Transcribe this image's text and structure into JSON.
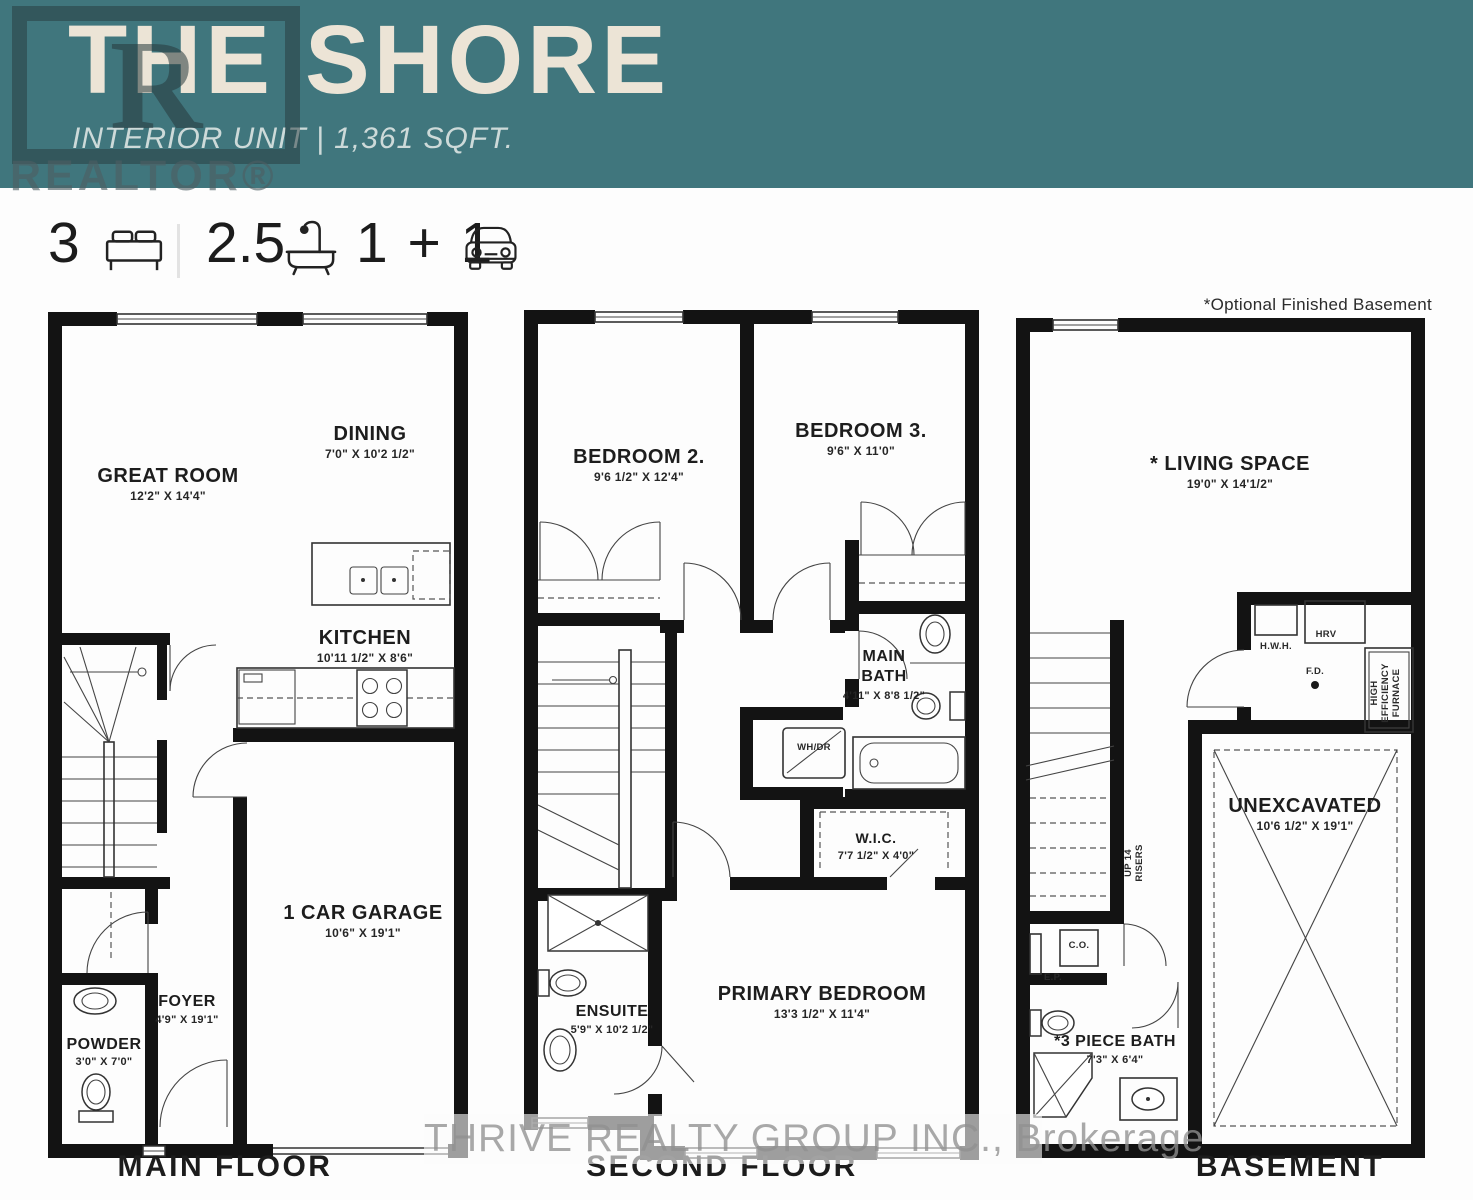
{
  "header": {
    "title": "THE SHORE",
    "subtitle": "INTERIOR UNIT | 1,361 SQFT.",
    "realtor_logo_letter": "R",
    "realtor_logo_word": "REALTOR®",
    "bg_color": "#40767d",
    "text_color": "#ece4d6"
  },
  "stats": {
    "beds": {
      "value": "3",
      "icon": "bed-icon"
    },
    "baths": {
      "value": "2.5",
      "icon": "bathtub-icon"
    },
    "parking": {
      "value": "1 + 1",
      "icon": "car-icon"
    }
  },
  "note": "*Optional Finished Basement",
  "watermark": "THRIVE REALTY GROUP INC., Brokerage",
  "floors": {
    "main": {
      "label": "MAIN FLOOR",
      "rooms": {
        "great_room": {
          "name": "GREAT ROOM",
          "dims": "12'2\" X 14'4\""
        },
        "dining": {
          "name": "DINING",
          "dims": "7'0\" X 10'2 1/2\""
        },
        "kitchen": {
          "name": "KITCHEN",
          "dims": "10'11 1/2\" X 8'6\""
        },
        "garage": {
          "name": "1 CAR GARAGE",
          "dims": "10'6\" X 19'1\""
        },
        "foyer": {
          "name": "FOYER",
          "dims": "4'9\" X 19'1\""
        },
        "powder": {
          "name": "POWDER",
          "dims": "3'0\" X 7'0\""
        }
      }
    },
    "second": {
      "label": "SECOND FLOOR",
      "rooms": {
        "bedroom2": {
          "name": "BEDROOM 2.",
          "dims": "9'6 1/2\" X 12'4\""
        },
        "bedroom3": {
          "name": "BEDROOM 3.",
          "dims": "9'6\" X 11'0\""
        },
        "main_bath": {
          "name_line1": "MAIN",
          "name_line2": "BATH",
          "dims": "4'11\" X 8'8 1/2\""
        },
        "laundry": {
          "name": "WH/DR"
        },
        "wic": {
          "name": "W.I.C.",
          "dims": "7'7 1/2\" X 4'0\""
        },
        "ensuite": {
          "name": "ENSUITE",
          "dims": "5'9\" X 10'2 1/2\""
        },
        "primary": {
          "name": "PRIMARY BEDROOM",
          "dims": "13'3 1/2\" X 11'4\""
        }
      }
    },
    "basement": {
      "label": "BASEMENT",
      "rooms": {
        "living": {
          "name": "* LIVING SPACE",
          "dims": "19'0\" X 14'1/2\""
        },
        "unexcavated": {
          "name": "UNEXCAVATED",
          "dims": "10'6 1/2\" X 19'1\""
        },
        "bath3": {
          "name": "*3 PIECE BATH",
          "dims": "7'3\" X 6'4\""
        },
        "hwh": "H.W.H.",
        "hrv": "HRV",
        "fd": "F.D.",
        "furnace_line1": "HIGH",
        "furnace_line2": "EFFICIENCY",
        "furnace_line3": "FURNACE",
        "stairs_line1": "UP 14",
        "stairs_line2": "RISERS",
        "co": "C.O.",
        "ep": "E.P."
      }
    }
  }
}
